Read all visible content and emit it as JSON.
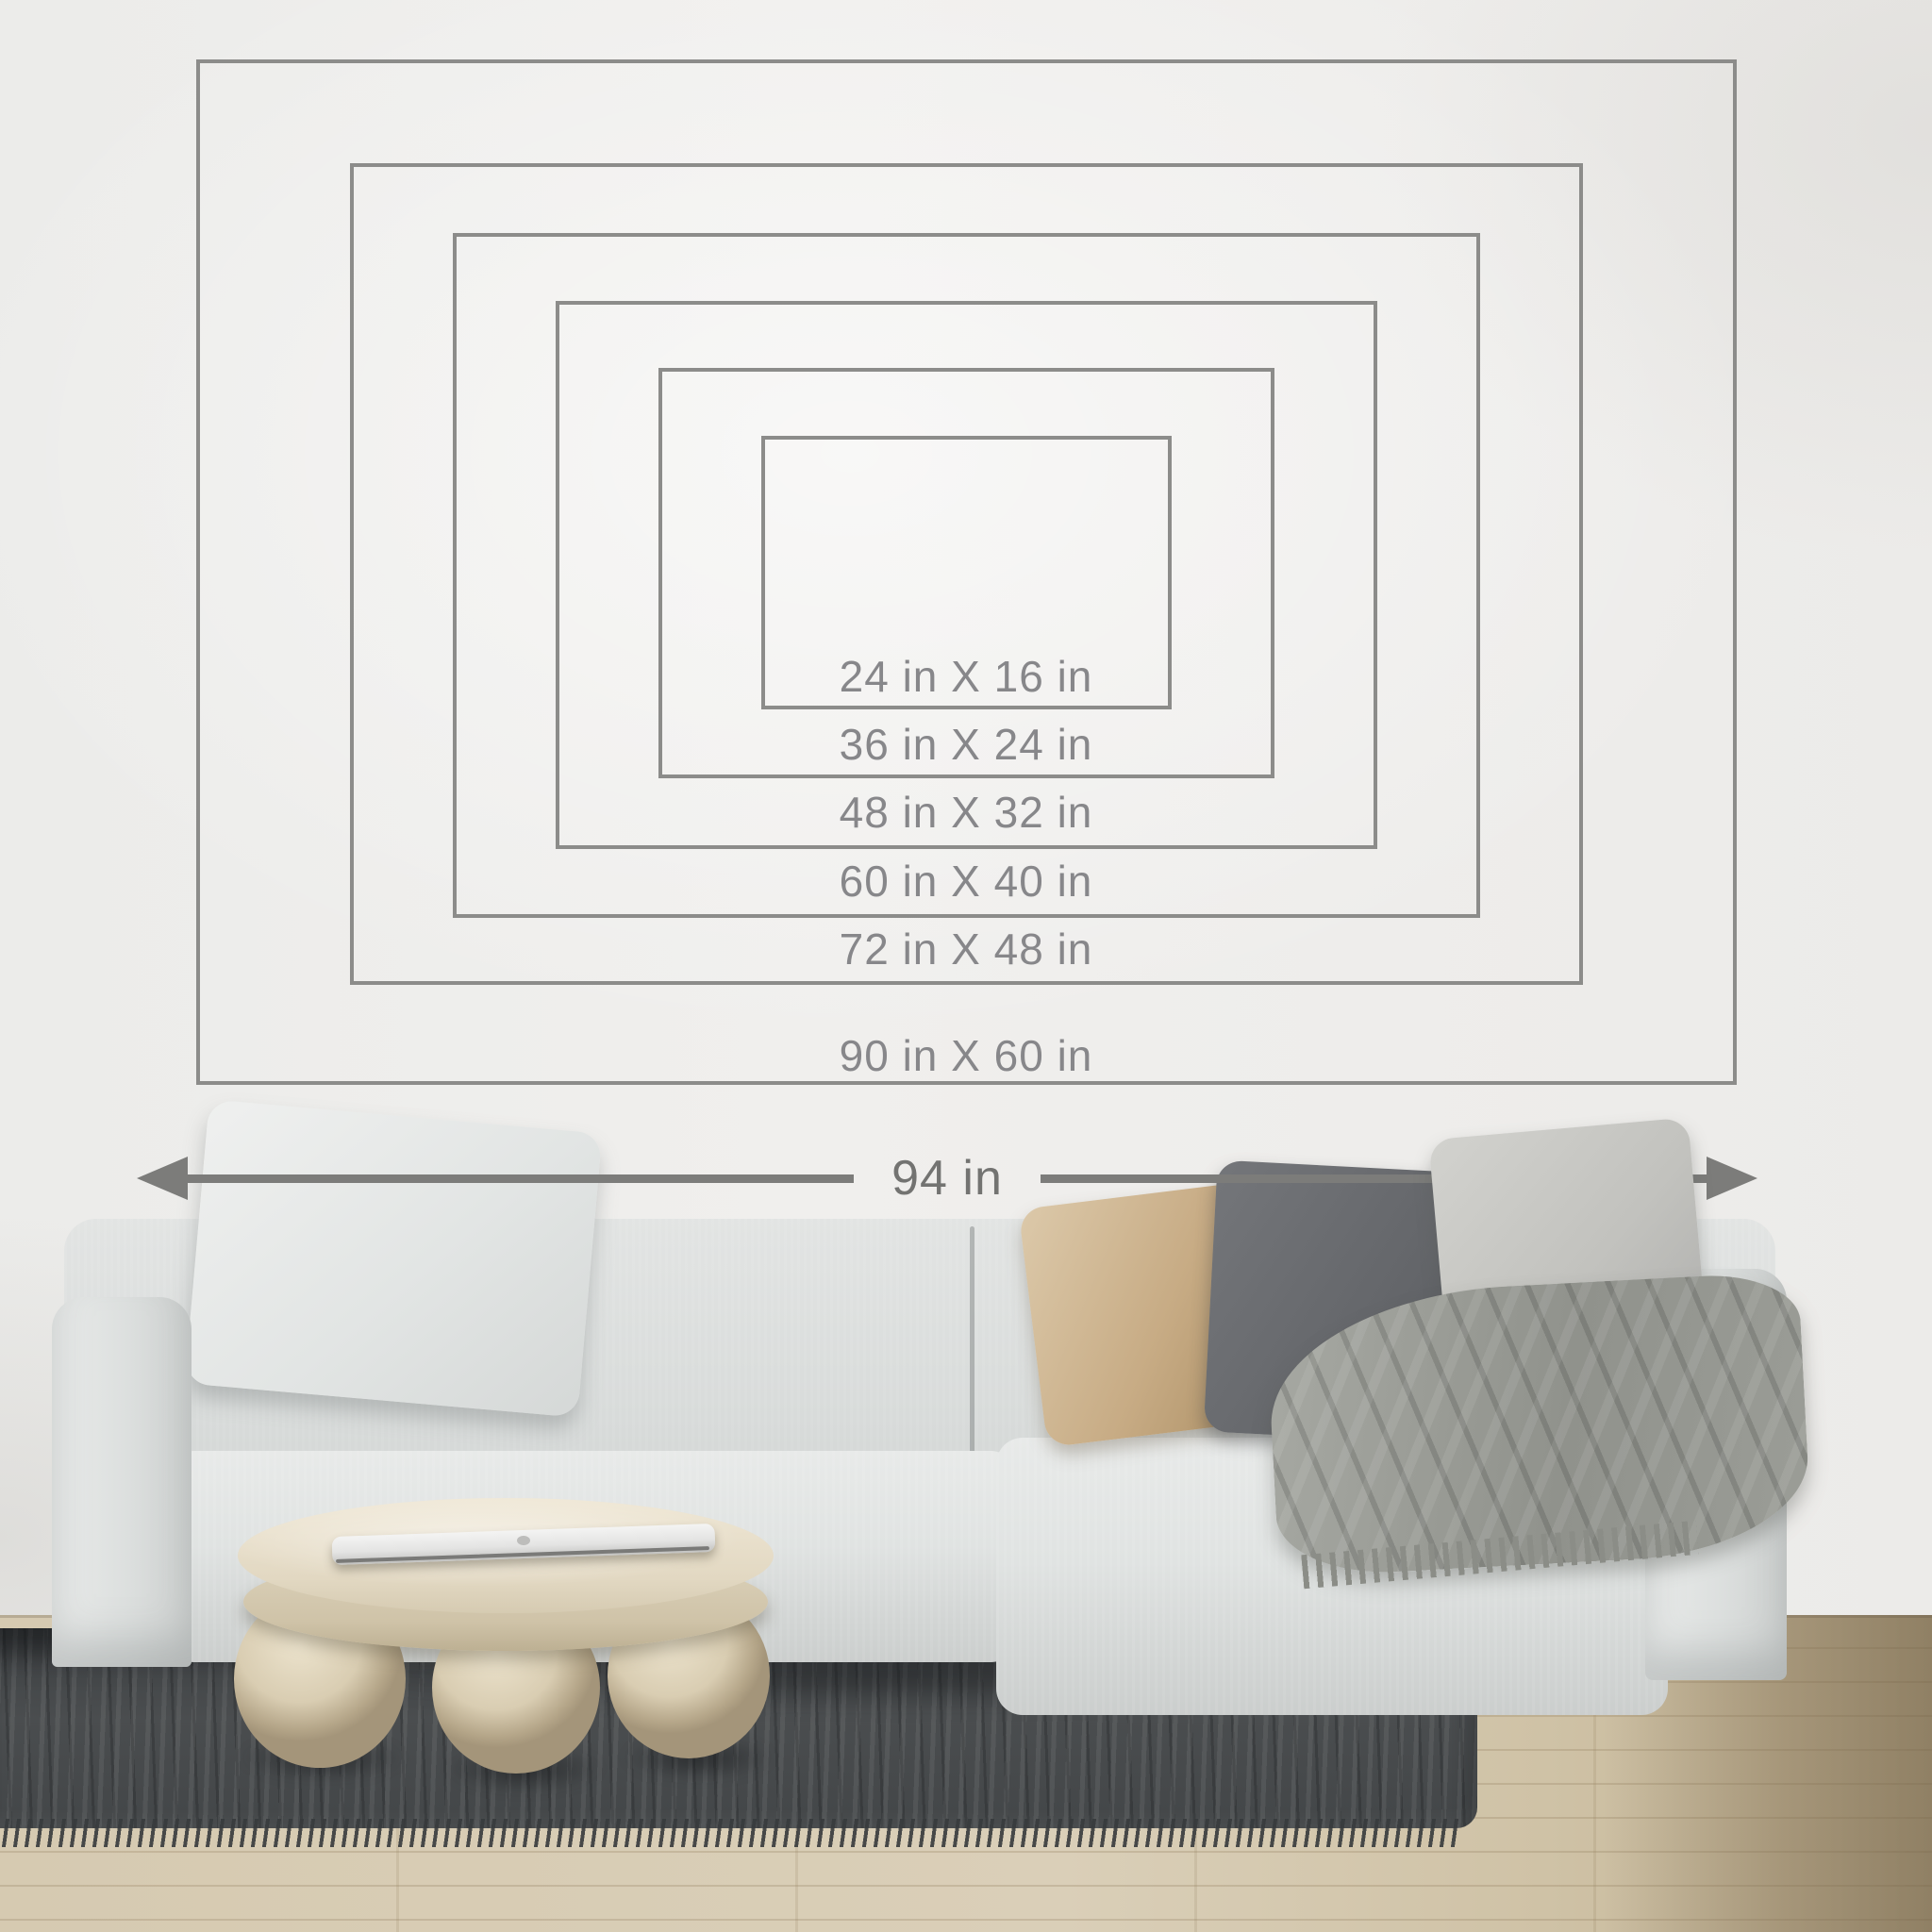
{
  "size_guide": {
    "unit": "in",
    "sizes": [
      {
        "label": "24 in X 16 in",
        "width_in": 24,
        "height_in": 16
      },
      {
        "label": "36 in X 24 in",
        "width_in": 36,
        "height_in": 24
      },
      {
        "label": "48 in X 32 in",
        "width_in": 48,
        "height_in": 32
      },
      {
        "label": "60 in X 40 in",
        "width_in": 60,
        "height_in": 40
      },
      {
        "label": "72 in X 48 in",
        "width_in": 72,
        "height_in": 48
      },
      {
        "label": "90 in X 60 in",
        "width_in": 90,
        "height_in": 60
      }
    ],
    "wall_width_label": "94 in",
    "wall_width_in": 94
  },
  "colors": {
    "outline": "#8c8c8a",
    "label_text": "#87878a",
    "arrow": "#7c7c7a",
    "wall": "#eeedeb",
    "sofa": "#dfe1e0",
    "pillow_white": "#e9ebe9",
    "pillow_tan": "#c7ab84",
    "pillow_dark_gray": "#64666a",
    "pillow_light_gray": "#c2c2be",
    "throw_blanket": "#9b9d97",
    "table": "#e2d8c2",
    "rug": "#4a4d4f",
    "floor": "#d6cab1"
  }
}
